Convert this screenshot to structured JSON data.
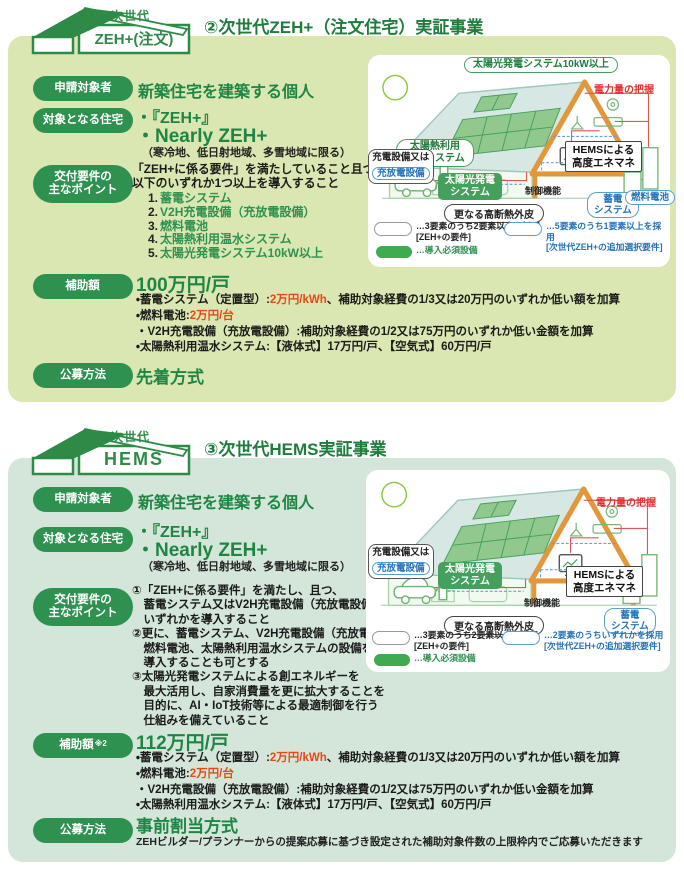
{
  "colors": {
    "pill_green": "#2f9150",
    "heading_green": "#1e7c3c",
    "value_green": "#1e8544",
    "panel1_bg": "#dbe7b2",
    "panel2_bg": "#d4e6da",
    "accent_red": "#e84913",
    "link_blue": "#2472b8",
    "frame_orange": "#e2973b"
  },
  "sections": [
    {
      "logo_line1": "次世代",
      "logo_line2": "ZEH+(注文)",
      "heading": "②次世代ZEH+（注文住宅）実証事業",
      "label_applicant": "申請対象者",
      "label_housing": "対象となる住宅",
      "label_requirements": "交付要件の\n主なポイント",
      "label_subsidy": "補助額",
      "label_subsidy_suffix": "",
      "label_method": "公募方法",
      "applicant": "新築住宅を建築する個人",
      "housing_item1": "・『ZEH+』",
      "housing_item2": "・Nearly ZEH+",
      "housing_note": "（寒冷地、低日射地域、多雪地域に限る）",
      "requirements_intro": "「ZEH+に係る要件」を満たしていること且つ、\n以下のいずれか1つ以上を導入すること",
      "requirements_list": [
        {
          "num": "1.",
          "text": "蓄電システム"
        },
        {
          "num": "2.",
          "text": "V2H充電設備（充放電設備）"
        },
        {
          "num": "3.",
          "text": "燃料電池"
        },
        {
          "num": "4.",
          "text": "太陽熱利用温水システム"
        },
        {
          "num": "5.",
          "text": "太陽光発電システム10kW以上"
        }
      ],
      "subsidy_amount": "100万円/戸",
      "subsidy_l1_pre": "・蓄電システム（定置型）:",
      "subsidy_l1_red": "2万円/kWh",
      "subsidy_l1_post": "、補助対象経費の1/3又は20万円のいずれか低い額を加算",
      "subsidy_l2_pre": "・燃料電池:",
      "subsidy_l2_red": "2万円/台",
      "subsidy_l3": "・V2H充電設備（充放電設備）:補助対象経費の1/2又は75万円のいずれか低い金額を加算",
      "subsidy_l4": "・太陽熱利用温水システム:【液体式】17万円/戸、【空気式】60万円/戸",
      "method": "先着方式",
      "method_note": "",
      "diagram": {
        "bubble_pv10kw": "太陽光発電システム10kW以上",
        "power_grasp": "電力量の把握",
        "bubble_solar_hot_water": "太陽熱利用\n温水システム",
        "bubble_charge_line1": "充電設備又は",
        "bubble_charge_line2": "充放電設備",
        "tag_pv": "太陽光発電\nシステム",
        "hems_box": "HEMSによる\n高度エネマネ",
        "control": "制御機能",
        "bubble_insulation": "更なる高断熱外皮",
        "bubble_battery": "蓄電\nシステム",
        "bubble_fuel_cell": "燃料電池",
        "legend_white": "…3要素のうち2要素以上を採用\n[ZEH+の要件]",
        "legend_blue": "…5要素のうち1要素以上を採用\n[次世代ZEH+の追加選択要件]",
        "legend_green": "…導入必須設備"
      }
    },
    {
      "logo_line1": "次世代",
      "logo_line2": "HEMS",
      "heading": "③次世代HEMS実証事業",
      "label_applicant": "申請対象者",
      "label_housing": "対象となる住宅",
      "label_requirements": "交付要件の\n主なポイント",
      "label_subsidy": "補助額",
      "label_subsidy_suffix": "※2",
      "label_method": "公募方法",
      "applicant": "新築住宅を建築する個人",
      "housing_item1": "・『ZEH+』",
      "housing_item2": "・Nearly ZEH+",
      "housing_note": "（寒冷地、低日射地域、多雪地域に限る）",
      "requirements_block": "①「ZEH+に係る要件」を満たし、且つ、\n　蓄電システム又はV2H充電設備（充放電設備）の\n　いずれかを導入すること\n②更に、蓄電システム、V2H充電設備（充放電設備）、\n　燃料電池、太陽熱利用温水システムの設備を\n　導入することも可とする\n③太陽光発電システムによる創エネルギーを\n　最大活用し、自家消費量を更に拡大することを\n　目的に、AI・IoT技術等による最適制御を行う\n　仕組みを備えていること",
      "subsidy_amount": "112万円/戸",
      "subsidy_l1_pre": "・蓄電システム（定置型）:",
      "subsidy_l1_red": "2万円/kWh",
      "subsidy_l1_post": "、補助対象経費の1/3又は20万円のいずれか低い額を加算",
      "subsidy_l2_pre": "・燃料電池:",
      "subsidy_l2_red": "2万円/台",
      "subsidy_l3": "・V2H充電設備（充放電設備）:補助対象経費の1/2又は75万円のいずれか低い金額を加算",
      "subsidy_l4": "・太陽熱利用温水システム:【液体式】17万円/戸、【空気式】60万円/戸",
      "method": "事前割当方式",
      "method_note": "ZEHビルダー/プランナーからの提案応募に基づき設定された補助対象件数の上限枠内でご応募いただきます",
      "diagram": {
        "power_grasp": "電力量の把握",
        "bubble_charge_line1": "充電設備又は",
        "bubble_charge_line2": "充放電設備",
        "tag_pv": "太陽光発電\nシステム",
        "hems_box": "HEMSによる\n高度エネマネ",
        "control": "制御機能",
        "bubble_insulation": "更なる高断熱外皮",
        "bubble_battery": "蓄電\nシステム",
        "legend_white": "…3要素のうち2要素以上を採用\n[ZEH+の要件]",
        "legend_blue": "…2要素のうちいずれかを採用\n[次世代ZEH+の追加選択要件]",
        "legend_green": "…導入必須設備"
      }
    }
  ]
}
